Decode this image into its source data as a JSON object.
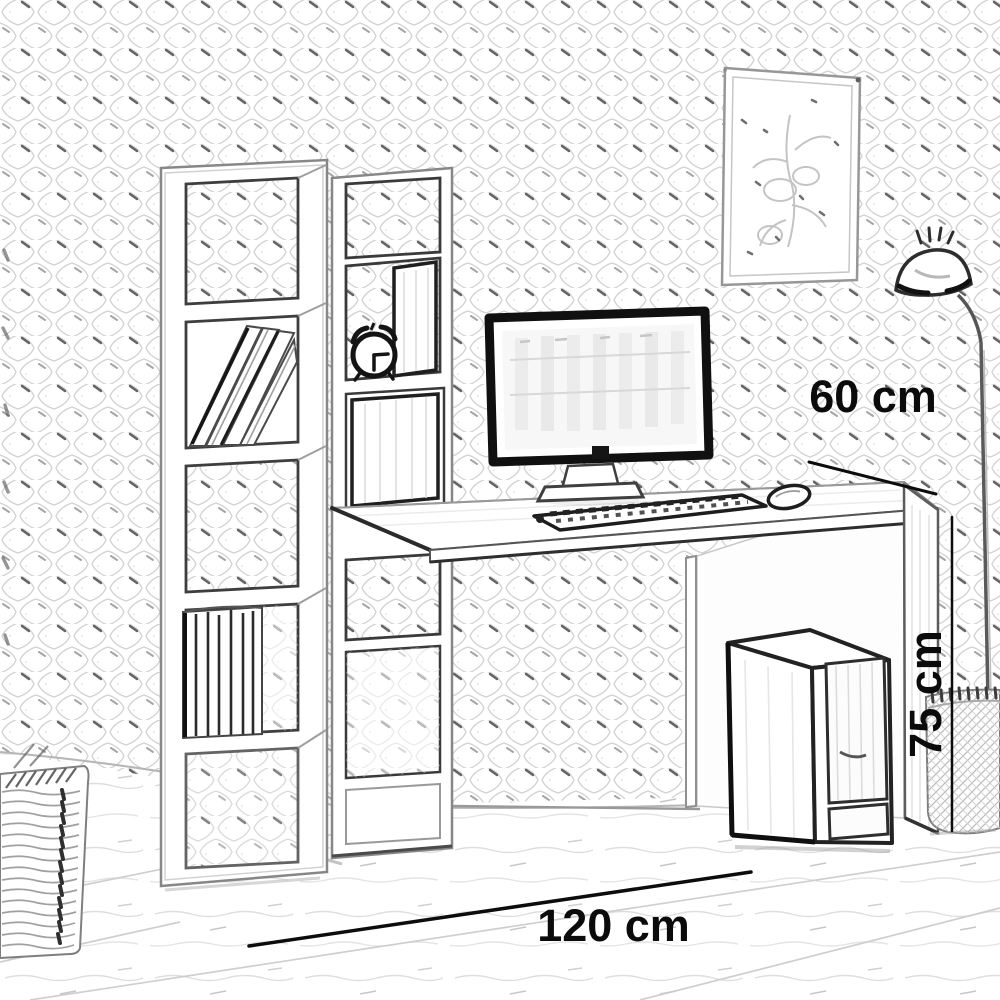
{
  "diagram": {
    "style": "pencil-sketch product dimension drawing",
    "subject": "computer desk with integrated bookshelf in a room",
    "dimension_labels": {
      "depth": "60 cm",
      "height": "75 cm",
      "width": "120 cm"
    },
    "objects": [
      "patterned-wall",
      "wood-floor",
      "picture-frame",
      "floor-lamp",
      "bookshelf-tower",
      "leaning-books",
      "standing-books",
      "shelf-column",
      "alarm-clock",
      "desk",
      "computer-monitor",
      "keyboard",
      "mouse",
      "pc-tower",
      "planter-basket",
      "wicker-basket"
    ],
    "colors": {
      "background": "#ffffff",
      "ink": "#0c0c0c",
      "pencil_light": "#cccccc",
      "pencil_mid": "#8a8a8a"
    }
  }
}
